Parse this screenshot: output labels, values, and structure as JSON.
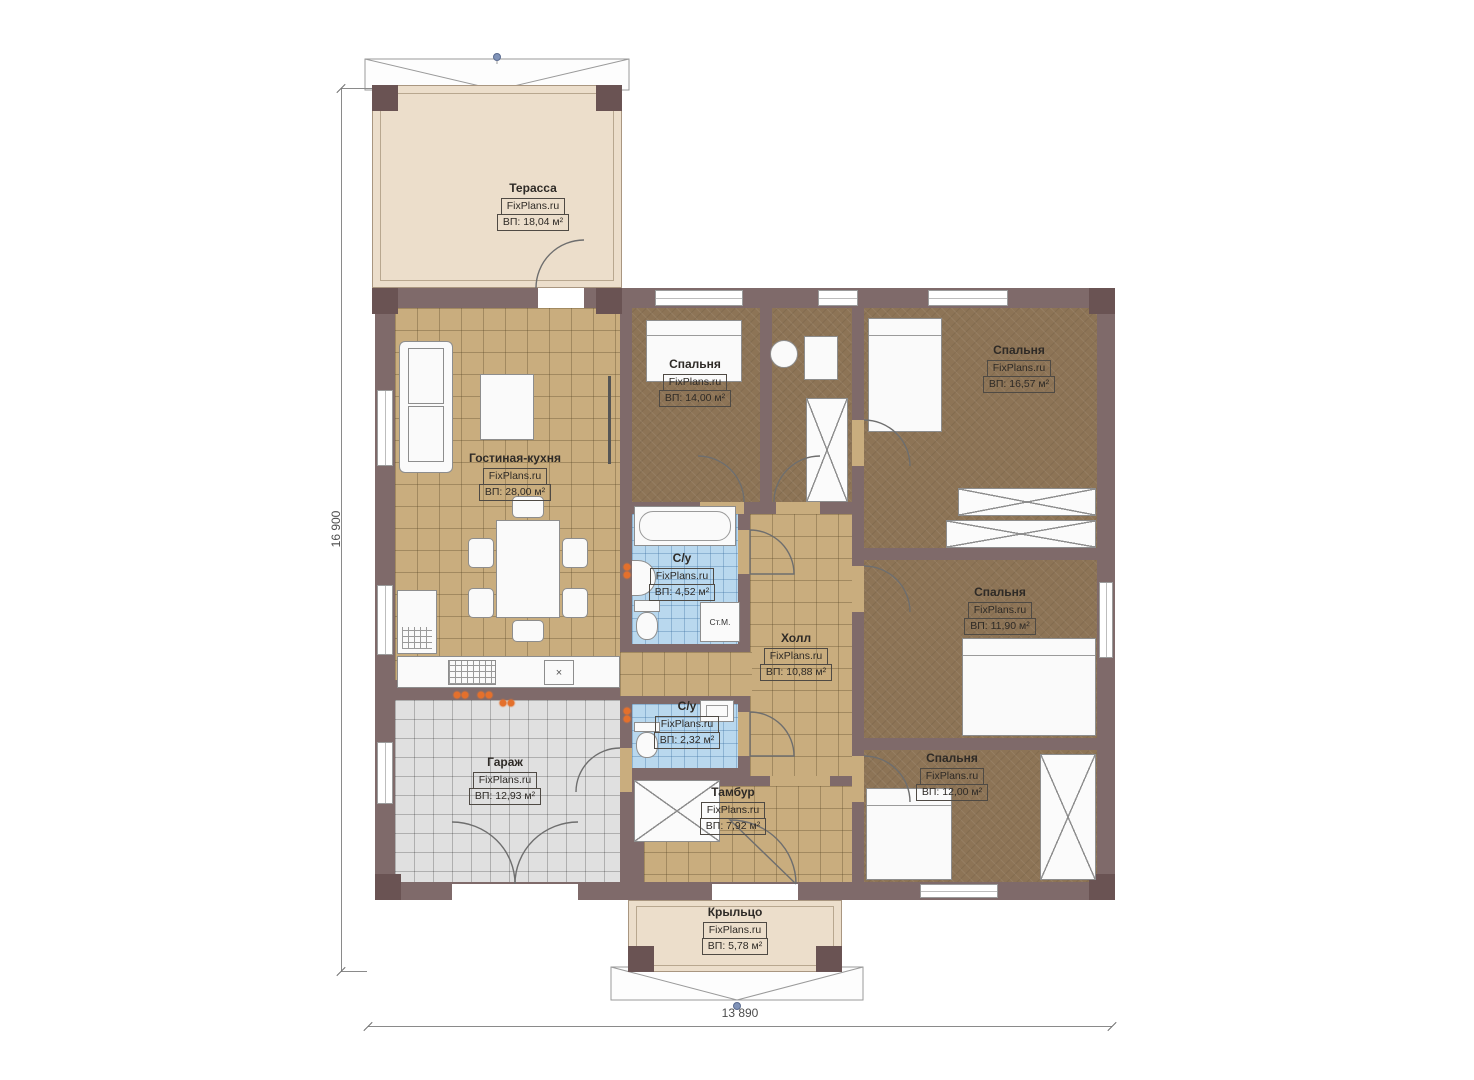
{
  "plan": {
    "height_label": "16 900",
    "width_label": "13 890"
  },
  "rooms": [
    {
      "id": "terrace",
      "name": "Терасса",
      "brand": "FixPlans.ru",
      "area": "ВП: 18,04 м²"
    },
    {
      "id": "living",
      "name": "Гостиная-кухня",
      "brand": "FixPlans.ru",
      "area": "ВП: 28,00 м²"
    },
    {
      "id": "bedroom-1",
      "name": "Спальня",
      "brand": "FixPlans.ru",
      "area": "ВП: 14,00 м²"
    },
    {
      "id": "bedroom-2",
      "name": "Спальня",
      "brand": "FixPlans.ru",
      "area": "ВП: 16,57 м²"
    },
    {
      "id": "bathroom-1",
      "name": "С/у",
      "brand": "FixPlans.ru",
      "area": "ВП: 4,52 м²"
    },
    {
      "id": "hall",
      "name": "Холл",
      "brand": "FixPlans.ru",
      "area": "ВП: 10,88 м²"
    },
    {
      "id": "bedroom-3",
      "name": "Спальня",
      "brand": "FixPlans.ru",
      "area": "ВП: 11,90 м²"
    },
    {
      "id": "bathroom-2",
      "name": "С/у",
      "brand": "FixPlans.ru",
      "area": "ВП: 2,32 м²"
    },
    {
      "id": "garage",
      "name": "Гараж",
      "brand": "FixPlans.ru",
      "area": "ВП: 12,93 м²"
    },
    {
      "id": "tambour",
      "name": "Тамбур",
      "brand": "FixPlans.ru",
      "area": "ВП: 7,92 м²"
    },
    {
      "id": "bedroom-4",
      "name": "Спальня",
      "brand": "FixPlans.ru",
      "area": "ВП: 12,00 м²"
    },
    {
      "id": "porch",
      "name": "Крыльцо",
      "brand": "FixPlans.ru",
      "area": "ВП: 5,78 м²"
    }
  ],
  "annotations": {
    "washing_machine": "Ст.М.",
    "sink_mark": "×"
  },
  "colors": {
    "wall": "#7f6a6a",
    "wall_post": "#6a5353",
    "floor_tile_tan": "#c9ad7e",
    "floor_bedroom_brown": "#8d7456",
    "floor_bathroom_blue": "#b9d8ee",
    "floor_garage_gray": "#e0e0e0",
    "terrace_beige": "#ecdecb",
    "lamp_orange": "#e4702c",
    "dimension_dot_blue": "#8093b8"
  }
}
